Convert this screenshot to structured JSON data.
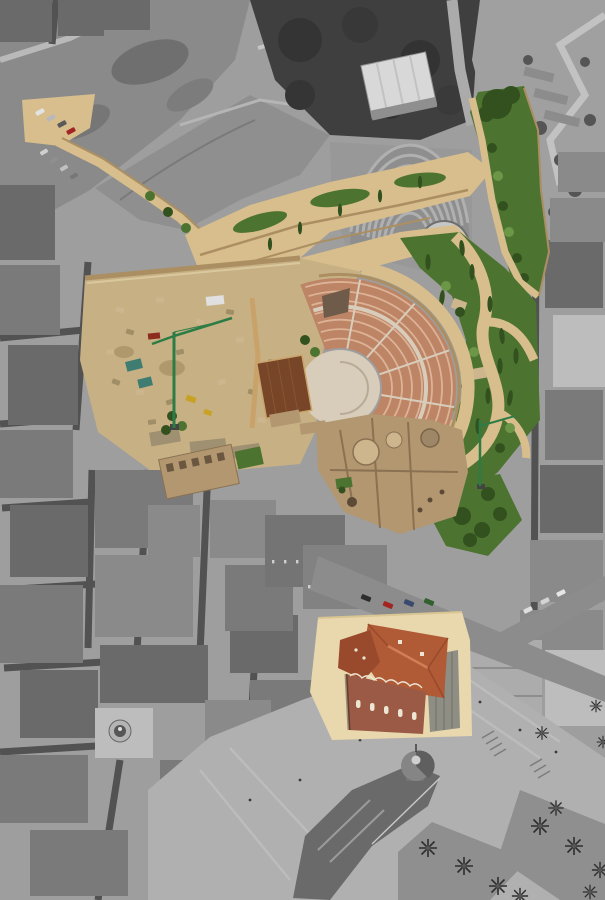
{
  "scene": {
    "subject": "aerial-view-archaeological-site-selective-color",
    "image_width_px": 605,
    "image_height_px": 900,
    "treatment": {
      "base": "grayscale",
      "highlight": "color"
    },
    "highlighted_regions": [
      "hillside-path",
      "parking-area",
      "access-ramps",
      "green-strip",
      "gardens",
      "garden-paths",
      "excavation-site",
      "construction-cranes",
      "roman-theatre-cavea",
      "orchestra",
      "stage-platform",
      "church-ruins",
      "colonnade-ruin",
      "street-cars",
      "museum-plaza",
      "museum-building"
    ],
    "grayscale_regions": [
      "city-blocks",
      "streets",
      "cliff-hillside",
      "park-trees",
      "auditorium",
      "apartment-block",
      "casa-arches-building",
      "gran-hotel-dome",
      "city-plaza",
      "town-hall",
      "town-hall-dome",
      "palm-trees"
    ]
  },
  "palette": {
    "base_gray": "#9e9e9e",
    "cliff_gray": "#8a8a8a",
    "foliage_gray": "#3f3f3f",
    "street_gray": "#525252",
    "plaza_gray": "#b0b0b0",
    "path_tan": "#d7be8c",
    "ground_tan": "#c7b184",
    "wall_tan": "#ab8f63",
    "pale_tan": "#d9c89d",
    "seat_terracotta": "#bd8466",
    "seat_row_light": "#dcb396",
    "orchestra_cream": "#d8cdbb",
    "stage_brown": "#774527",
    "ruin_sepia": "#b29770",
    "ruin_light": "#cdb68e",
    "ruin_shadow": "#8a7152",
    "green_dark": "#33511e",
    "green_mid": "#4c7330",
    "green_bright": "#6b9747",
    "crane_green": "#2e7c45",
    "roof_red": "#b05a36",
    "roof_red_dark": "#994a2c",
    "brick_red": "#9a5a45",
    "ridge_light": "#cf7e55",
    "plaza_cream": "#e9d8ad",
    "window_cream": "#eee6d4",
    "car_red": "#a32420",
    "car_green": "#32602f",
    "car_blue": "#3a4a6e",
    "car_dark": "#2e2e2e",
    "van_gray": "#9a9a9a",
    "white": "#e2e2e2",
    "teal_tarp": "#3f7d72",
    "machine_yellow": "#c8a227",
    "skip_red": "#8e2b1f",
    "wood_brown": "#c9a26a"
  }
}
